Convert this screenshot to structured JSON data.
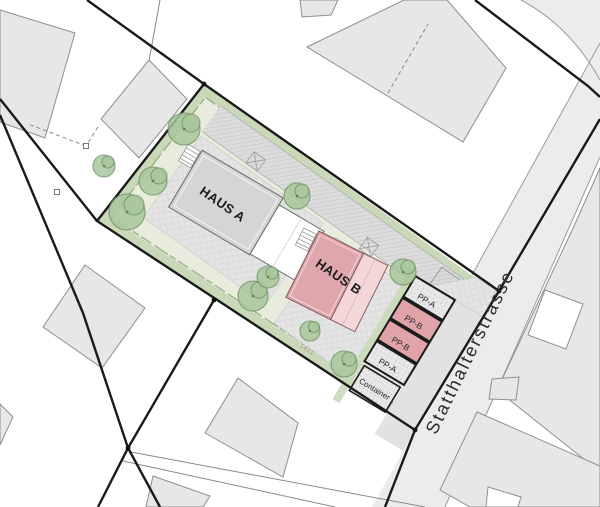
{
  "plan": {
    "site": {
      "parcel_number": "1411"
    },
    "buildings": {
      "haus_a": {
        "label": "HAUS A"
      },
      "haus_b": {
        "label": "HAUS B"
      }
    },
    "street": {
      "name": "Statthalterstrasse"
    },
    "parking": {
      "stalls": [
        {
          "label": "PP-A",
          "type": "A"
        },
        {
          "label": "PP-B",
          "type": "B"
        },
        {
          "label": "PP-B",
          "type": "B"
        },
        {
          "label": "PP-A",
          "type": "A"
        }
      ],
      "container_label": "Container"
    },
    "colors": {
      "lawn": "#e9ecdc",
      "hedge": "#c9d8b8",
      "hedge_line": "#8fad7e",
      "tree": "#a9c79d",
      "tree_line": "#6e9566",
      "street": "#ececec",
      "neighbor_building": "#e7e7e7",
      "road_band": "#dcdcdc",
      "haus_a": "#d5d5d5",
      "haus_a_light": "#ffffff",
      "haus_b": "#dfa7ab",
      "haus_b_light": "#f2d6d8",
      "stall_b": "#dfa3a8",
      "boundary": "#1a1a1a"
    }
  }
}
